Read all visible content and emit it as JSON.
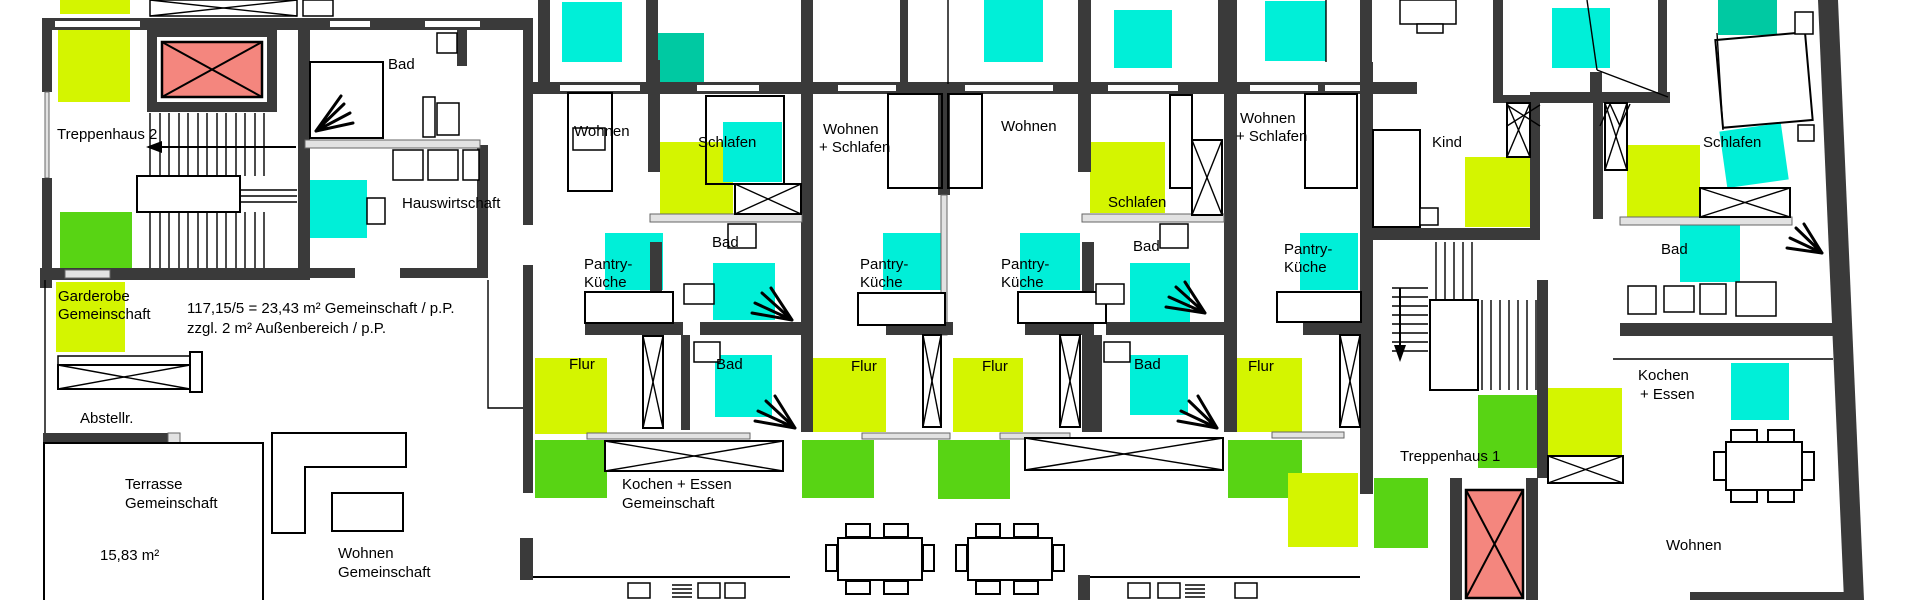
{
  "colors": {
    "wall": "#3a3a3a",
    "cyan": "#00efd8",
    "teal": "#00c9a2",
    "yellow": "#d4f500",
    "green": "#58d414",
    "salmon": "#f4867e",
    "window_gray": "#e2e2e2"
  },
  "annotation": {
    "line1": "117,15/5 = 23,43 m² Gemeinschaft / p.P.",
    "line2": "zzgl. 2 m² Außenbereich / p.P."
  },
  "labels": {
    "treppenhaus2": "Treppenhaus 2",
    "treppenhaus1": "Treppenhaus 1",
    "bad_entry": "Bad",
    "hauswirtschaft": "Hauswirtschaft",
    "garderobe_l1": "Garderobe",
    "garderobe_l2": "Gemeinschaft",
    "abstellraum": "Abstellr.",
    "terrasse_l1": "Terrasse",
    "terrasse_l2": "Gemeinschaft",
    "terrasse_area": "15,83 m²",
    "wohnen_gem_l1": "Wohnen",
    "wohnen_gem_l2": "Gemeinschaft",
    "kochen_gem_l1": "Kochen + Essen",
    "kochen_gem_l2": "Gemeinschaft",
    "unit1_wohnen": "Wohnen",
    "unit1_schlafen": "Schlafen",
    "unit1_pantry_l1": "Pantry-",
    "unit1_pantry_l2": "Küche",
    "unit1_bad": "Bad",
    "unit1_flur": "Flur",
    "bad_lower_west": "Bad",
    "unit2_wohnen_l1": "Wohnen",
    "unit2_wohnen_l2": "+ Schlafen",
    "unit2_pantry_l1": "Pantry-",
    "unit2_pantry_l2": "Küche",
    "unit2_flur": "Flur",
    "unit3_wohnen": "Wohnen",
    "unit3_schlafen": "Schlafen",
    "unit3_pantry_l1": "Pantry-",
    "unit3_pantry_l2": "Küche",
    "unit3_bad": "Bad",
    "unit3_flur": "Flur",
    "bad_lower_east": "Bad",
    "unit4_wohnen_l1": "Wohnen",
    "unit4_wohnen_l2": "+ Schlafen",
    "unit4_pantry_l1": "Pantry-",
    "unit4_pantry_l2": "Küche",
    "unit4_flur": "Flur",
    "kind": "Kind",
    "unit5_schlafen": "Schlafen",
    "unit5_bad": "Bad",
    "unit5_kochen_l1": "Kochen",
    "unit5_kochen_l2": "+ Essen",
    "unit5_wohnen": "Wohnen"
  }
}
